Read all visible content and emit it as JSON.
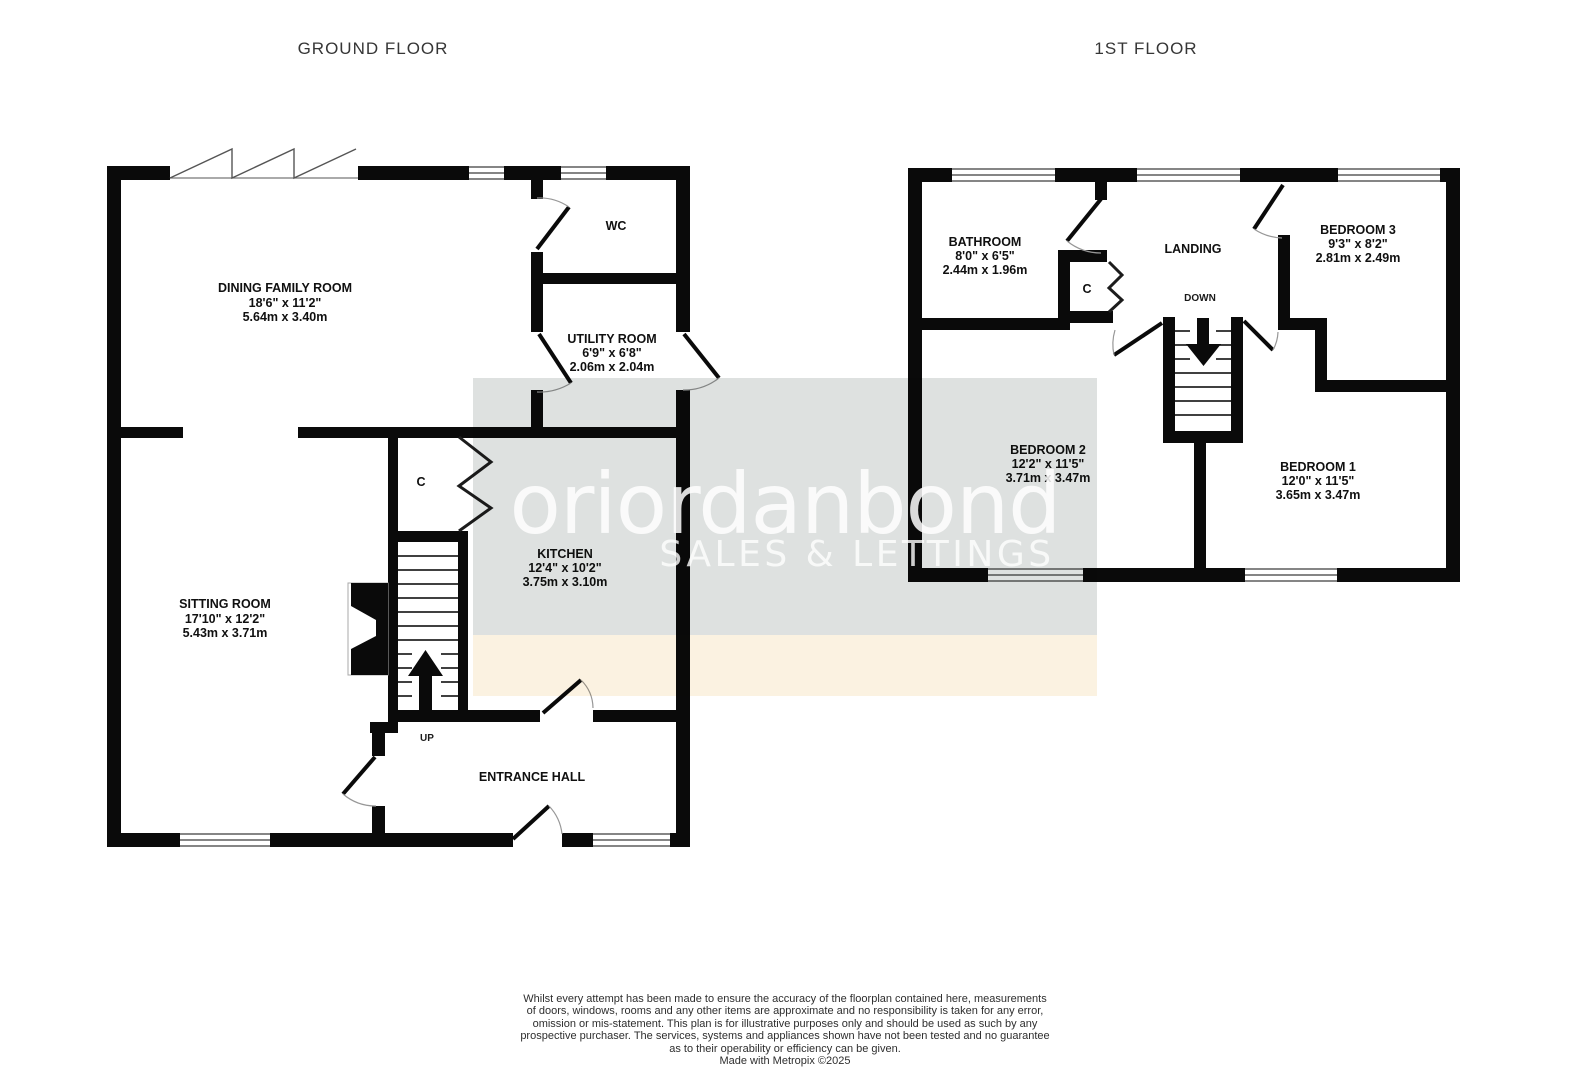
{
  "ground": {
    "title": "GROUND FLOOR",
    "dining": {
      "name": "DINING FAMILY ROOM",
      "imp": "18'6\" x 11'2\"",
      "met": "5.64m x 3.40m"
    },
    "wc": {
      "name": "WC"
    },
    "utility": {
      "name": "UTILITY ROOM",
      "imp": "6'9\" x 6'8\"",
      "met": "2.06m x 2.04m"
    },
    "kitchen": {
      "name": "KITCHEN",
      "imp": "12'4\" x 10'2\"",
      "met": "3.75m x 3.10m"
    },
    "sitting": {
      "name": "SITTING ROOM",
      "imp": "17'10\" x 12'2\"",
      "met": "5.43m x 3.71m"
    },
    "hall": {
      "name": "ENTRANCE HALL"
    },
    "cupboard": {
      "name": "C"
    },
    "stairs_label": "UP"
  },
  "first": {
    "title": "1ST FLOOR",
    "bathroom": {
      "name": "BATHROOM",
      "imp": "8'0\" x 6'5\"",
      "met": "2.44m x 1.96m"
    },
    "landing": {
      "name": "LANDING"
    },
    "cupboard": {
      "name": "C"
    },
    "stairs_label": "DOWN",
    "bed1": {
      "name": "BEDROOM 1",
      "imp": "12'0\" x 11'5\"",
      "met": "3.65m x 3.47m"
    },
    "bed2": {
      "name": "BEDROOM 2",
      "imp": "12'2\" x 11'5\"",
      "met": "3.71m x 3.47m"
    },
    "bed3": {
      "name": "BEDROOM 3",
      "imp": "9'3\" x 8'2\"",
      "met": "2.81m x 2.49m"
    }
  },
  "watermark": {
    "logo": "oriordanbond",
    "tagline": "SALES & LETTINGS",
    "band_gray": "#d8dcda",
    "band_cream": "#faf0dc"
  },
  "disclaimer": {
    "lines": [
      "Whilst every attempt has been made to ensure the accuracy of the floorplan contained here, measurements",
      "of doors, windows, rooms and any other items are approximate and no responsibility is taken for any error,",
      "omission or mis-statement. This plan is for illustrative purposes only and should be used as such by any",
      "prospective purchaser. The services, systems and appliances shown have not been tested and no guarantee",
      "as to their operability or efficiency can be given.",
      "Made with Metropix ©2025"
    ]
  },
  "colors": {
    "wall": "#0a0a0a",
    "arc": "#979797",
    "text": "#101010"
  }
}
